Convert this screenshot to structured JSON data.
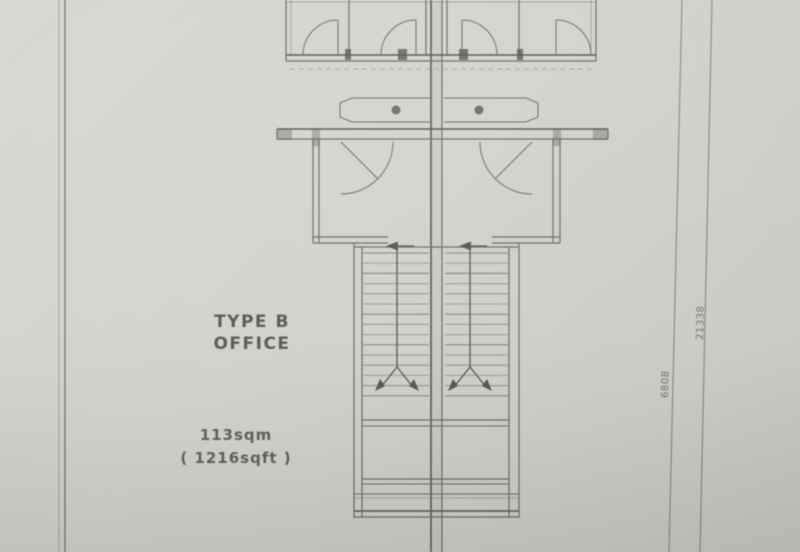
{
  "labels": {
    "type_line1": "TYPE B",
    "type_line2": "OFFICE",
    "area_line1": "113sqm",
    "area_line2": "( 1216sqft )"
  },
  "dimensions": {
    "outer_vertical": "21338",
    "inner_vertical": "6808"
  },
  "colors": {
    "paper": "#d3d2cc",
    "paper-dark": "#c8c7c1",
    "paper-light": "#d7d6d0",
    "line": "#6d6c64",
    "line-dark": "#57564f",
    "ink": "#4b4a44",
    "dim": "#74736b"
  }
}
